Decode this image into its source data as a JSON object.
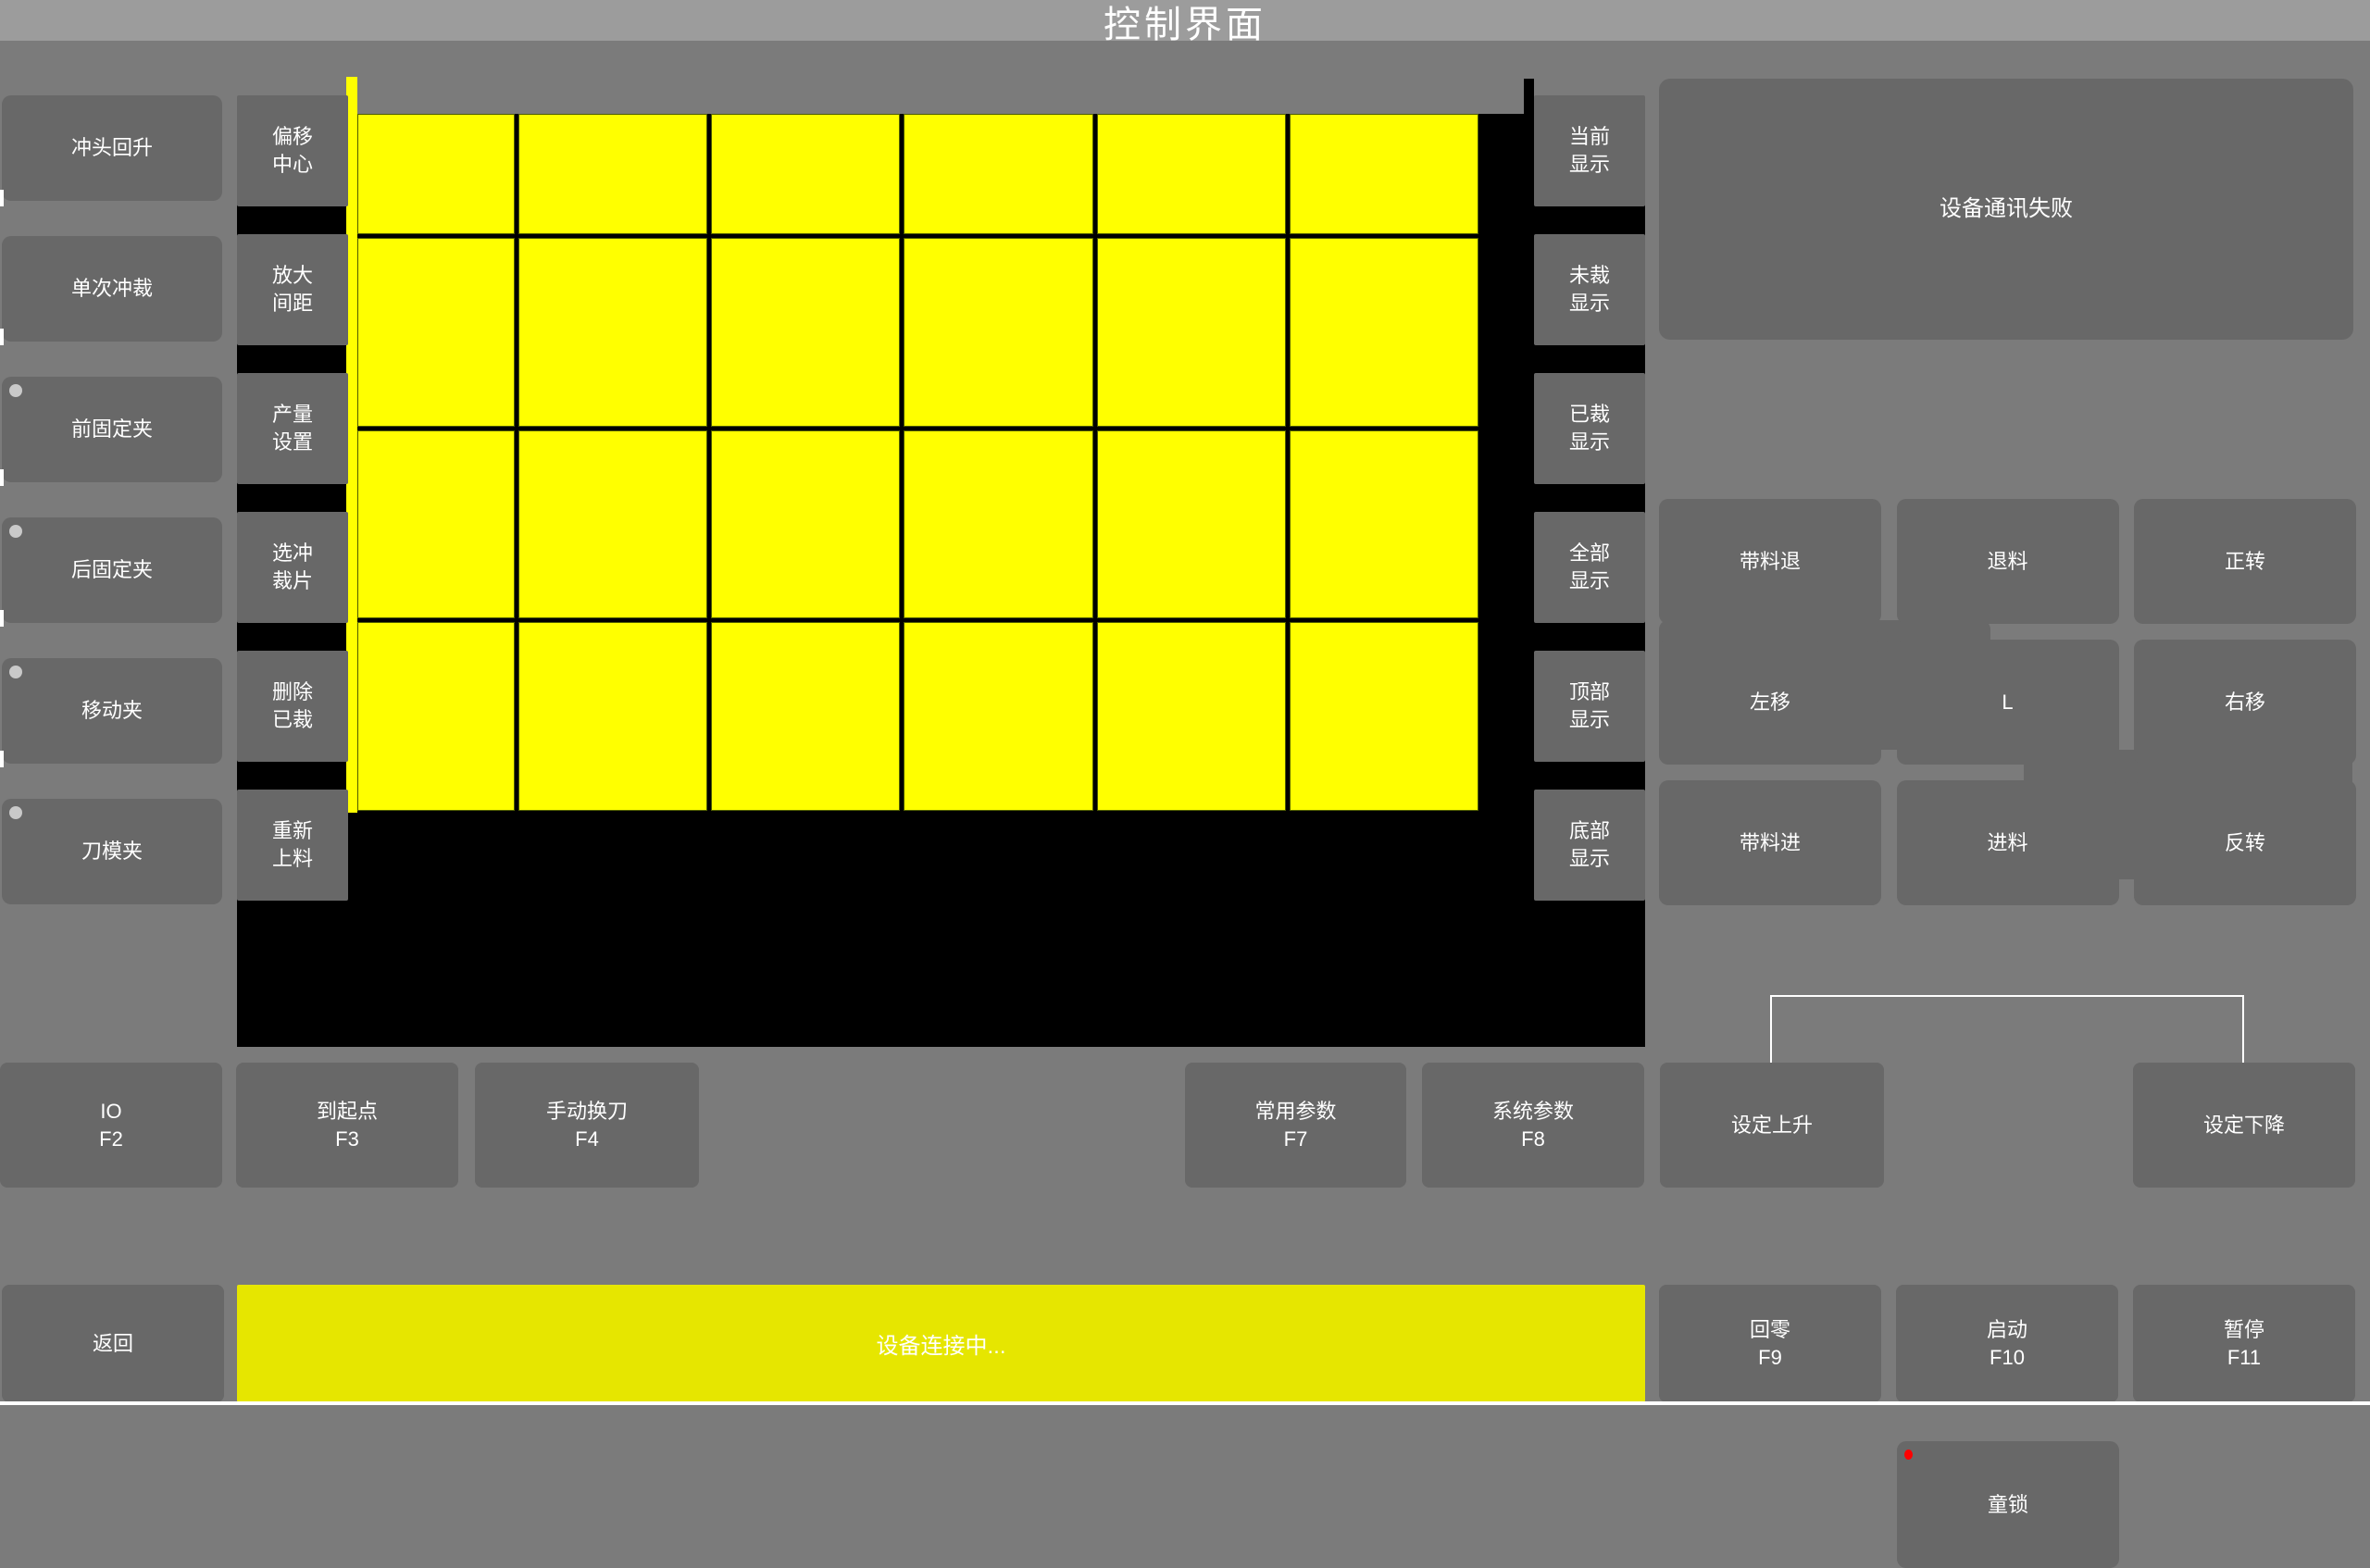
{
  "title": "控制界面",
  "left_buttons": [
    {
      "label": "冲头回升",
      "has_dot": false
    },
    {
      "label": "单次冲裁",
      "has_dot": false
    },
    {
      "label": "前固定夹",
      "has_dot": true
    },
    {
      "label": "后固定夹",
      "has_dot": true
    },
    {
      "label": "移动夹",
      "has_dot": true
    },
    {
      "label": "刀模夹",
      "has_dot": true
    }
  ],
  "tool_buttons": [
    {
      "line1": "偏移",
      "line2": "中心"
    },
    {
      "line1": "放大",
      "line2": "间距"
    },
    {
      "line1": "产量",
      "line2": "设置"
    },
    {
      "line1": "选冲",
      "line2": "裁片"
    },
    {
      "line1": "删除",
      "line2": "已裁"
    },
    {
      "line1": "重新",
      "line2": "上料"
    }
  ],
  "display_buttons": [
    {
      "line1": "当前",
      "line2": "显示"
    },
    {
      "line1": "未裁",
      "line2": "显示"
    },
    {
      "line1": "已裁",
      "line2": "显示"
    },
    {
      "line1": "全部",
      "line2": "显示"
    },
    {
      "line1": "顶部",
      "line2": "显示"
    },
    {
      "line1": "底部",
      "line2": "显示"
    }
  ],
  "grid": {
    "columns": 6,
    "rows": 4
  },
  "right_panel": {
    "message": "设备通讯失败",
    "mode_button": "连续",
    "value_display": "0.00",
    "jog": [
      "带料退",
      "退料",
      "正转",
      "左移",
      "L",
      "右移",
      "带料进",
      "进料",
      "反转"
    ],
    "child_lock": "童锁"
  },
  "function_row": [
    {
      "label": "IO",
      "key": "F2"
    },
    {
      "label": "到起点",
      "key": "F3"
    },
    {
      "label": "手动换刀",
      "key": "F4"
    },
    {
      "label": "常用参数",
      "key": "F7"
    },
    {
      "label": "系统参数",
      "key": "F8"
    },
    {
      "label": "设定上升",
      "key": ""
    },
    {
      "label": "设定下降",
      "key": ""
    }
  ],
  "bottom_bar": {
    "back": "返回",
    "status": "设备连接中...",
    "buttons": [
      {
        "label": "回零",
        "key": "F9"
      },
      {
        "label": "启动",
        "key": "F10"
      },
      {
        "label": "暂停",
        "key": "F11"
      }
    ]
  },
  "colors": {
    "page_bg": "#7b7b7b",
    "titlebar_bg": "#9c9c9c",
    "button_bg": "#686868",
    "canvas_bg": "#000000",
    "cell_yellow": "#ffff00",
    "cell_border": "#4e5c00",
    "status_yellow": "#e6e600",
    "alert_red": "#ff0000",
    "text": "#ffffff"
  }
}
